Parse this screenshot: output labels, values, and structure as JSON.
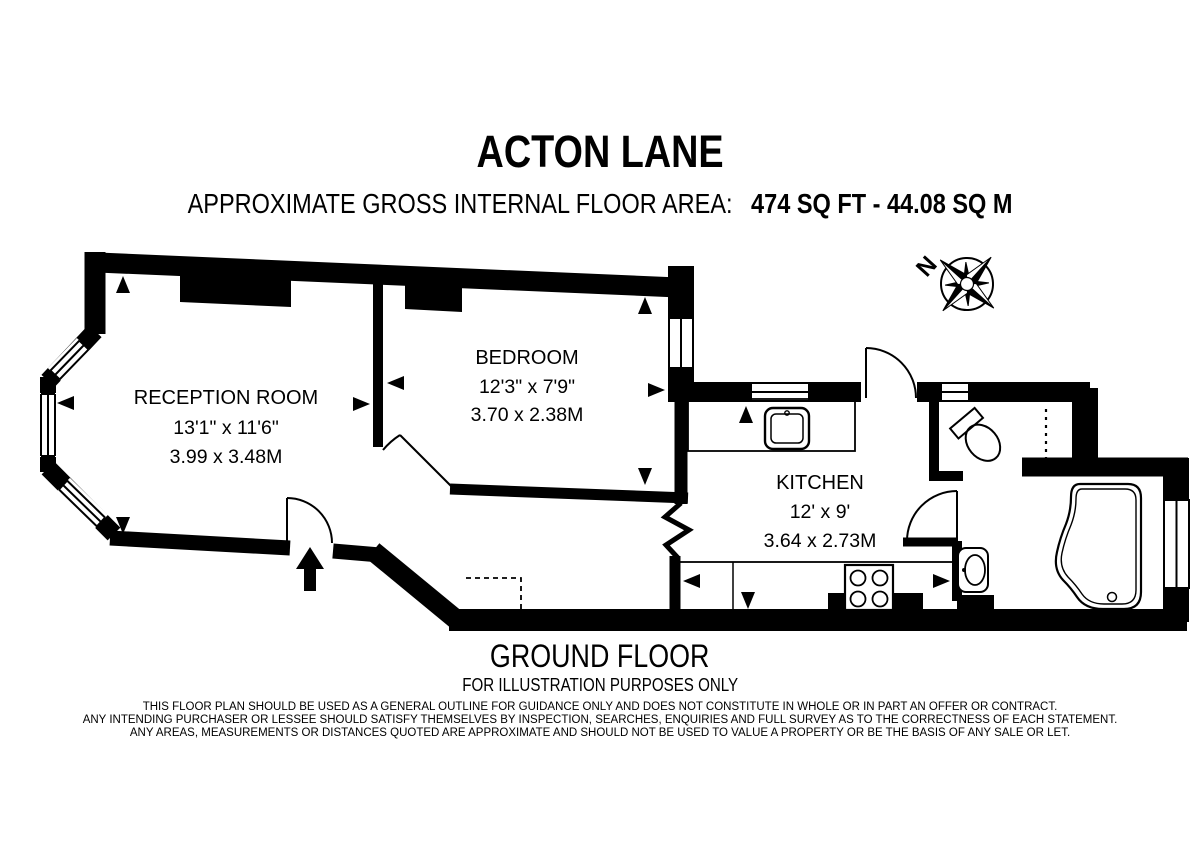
{
  "header": {
    "title": "ACTON LANE",
    "area_label": "APPROXIMATE GROSS INTERNAL FLOOR AREA:",
    "area_value": "474 SQ FT  -  44.08 SQ M"
  },
  "rooms": {
    "reception": {
      "name": "RECEPTION ROOM",
      "imperial": "13'1\" x 11'6\"",
      "metric": "3.99 x 3.48M"
    },
    "bedroom": {
      "name": "BEDROOM",
      "imperial": "12'3\" x 7'9\"",
      "metric": "3.70 x 2.38M"
    },
    "kitchen": {
      "name": "KITCHEN",
      "imperial": "12' x 9'",
      "metric": "3.64 x 2.73M"
    }
  },
  "compass": {
    "north_label": "N"
  },
  "icons": {
    "compass": "compass-rose",
    "entrance": "entrance-arrow",
    "fixtures": "kitchen-sink, hob, washbasin, toilet, bathtub, bay-window"
  },
  "footer": {
    "floor": "GROUND FLOOR",
    "illustration": "FOR ILLUSTRATION PURPOSES ONLY",
    "disclaimer": [
      "THIS FLOOR PLAN SHOULD BE USED AS A GENERAL OUTLINE FOR GUIDANCE ONLY AND DOES NOT CONSTITUTE IN WHOLE OR IN PART AN OFFER OR CONTRACT.",
      "ANY INTENDING PURCHASER OR LESSEE SHOULD SATISFY THEMSELVES BY INSPECTION, SEARCHES, ENQUIRIES AND FULL SURVEY AS TO THE CORRECTNESS OF EACH STATEMENT.",
      "ANY AREAS, MEASUREMENTS OR DISTANCES QUOTED ARE APPROXIMATE AND SHOULD NOT BE USED TO VALUE A PROPERTY OR BE THE BASIS OF ANY SALE OR LET."
    ]
  },
  "colors": {
    "ink": "#000000",
    "background": "#ffffff"
  }
}
